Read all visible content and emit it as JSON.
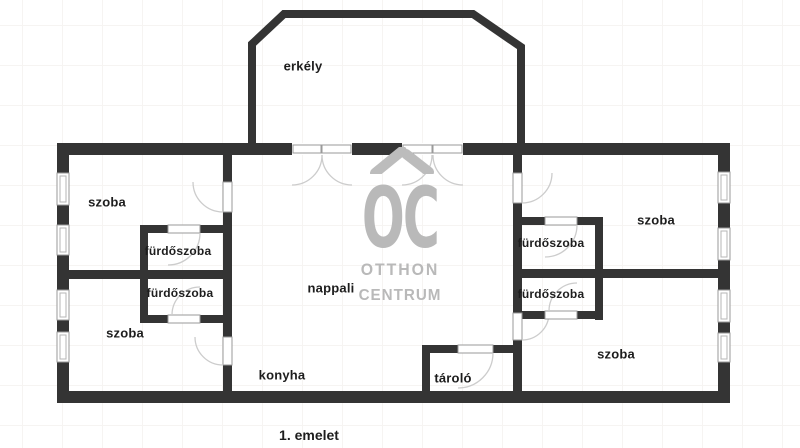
{
  "page": {
    "floor_label": "1. emelet"
  },
  "watermark": {
    "logo_text": "OC",
    "line1": "OTTHON",
    "line2": "CENTRUM",
    "color": "#b9b9b9"
  },
  "rooms": [
    {
      "id": "erkely",
      "label": "erkély",
      "cx": 303,
      "cy": 66,
      "fs": 13
    },
    {
      "id": "szoba-top-left",
      "label": "szoba",
      "cx": 107,
      "cy": 202,
      "fs": 13
    },
    {
      "id": "furdoszoba-left-top",
      "label": "fürdőszoba",
      "cx": 178,
      "cy": 251,
      "fs": 12
    },
    {
      "id": "furdoszoba-left-bottom",
      "label": "fürdőszoba",
      "cx": 180,
      "cy": 293,
      "fs": 12
    },
    {
      "id": "szoba-bottom-left",
      "label": "szoba",
      "cx": 125,
      "cy": 333,
      "fs": 13
    },
    {
      "id": "nappali",
      "label": "nappali",
      "cx": 331,
      "cy": 288,
      "fs": 13
    },
    {
      "id": "konyha",
      "label": "konyha",
      "cx": 282,
      "cy": 375,
      "fs": 13
    },
    {
      "id": "tarolo",
      "label": "tároló",
      "cx": 453,
      "cy": 378,
      "fs": 13
    },
    {
      "id": "furdoszoba-right-top",
      "label": "fürdőszoba",
      "cx": 551,
      "cy": 243,
      "fs": 12
    },
    {
      "id": "furdoszoba-right-bottom",
      "label": "fürdőszoba",
      "cx": 551,
      "cy": 294,
      "fs": 12
    },
    {
      "id": "szoba-top-right",
      "label": "szoba",
      "cx": 656,
      "cy": 220,
      "fs": 13
    },
    {
      "id": "szoba-bottom-right",
      "label": "szoba",
      "cx": 616,
      "cy": 354,
      "fs": 13
    }
  ],
  "colors": {
    "wall": "#343434",
    "frame": "#9a9a9a",
    "frame_inner": "#b5b5b5",
    "door_arc": "#cccccc",
    "label_text": "#1d1d1d",
    "watermark_grey": "#b9b9b9"
  }
}
